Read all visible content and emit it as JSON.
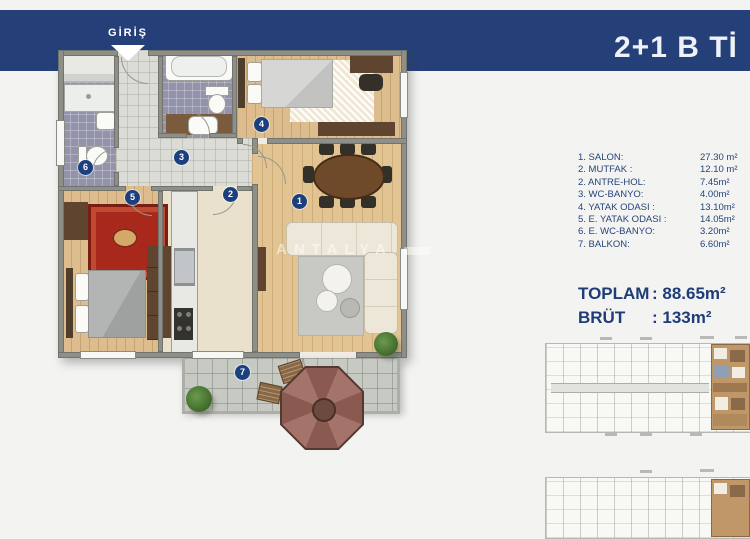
{
  "banner": {
    "title": "2+1 B Tİ",
    "entrance_label": "GİRİŞ"
  },
  "watermark": "ANTALYA",
  "markers": [
    "1",
    "2",
    "3",
    "4",
    "5",
    "6",
    "7"
  ],
  "room_list": {
    "rows": [
      {
        "label": "1. SALON:",
        "value": "27.30 m²"
      },
      {
        "label": "2. MUTFAK :",
        "value": "12.10 m²"
      },
      {
        "label": "2. ANTRE-HOL:",
        "value": "7.45m²"
      },
      {
        "label": "3. WC-BANYO:",
        "value": "4.00m²"
      },
      {
        "label": "4. YATAK ODASI :",
        "value": "13.10m²"
      },
      {
        "label": "5. E. YATAK ODASI :",
        "value": "14.05m²"
      },
      {
        "label": "6. E. WC-BANYO:",
        "value": "3.20m²"
      },
      {
        "label": "7. BALKON:",
        "value": "6.60m²"
      }
    ]
  },
  "totals": {
    "toplam_label": "TOPLAM",
    "toplam_value": ": 88.65m²",
    "brut_label": "BRÜT",
    "brut_value": ": 133m²"
  },
  "colors": {
    "accent_navy": "#25407b",
    "highlight_tan": "#c09768"
  }
}
